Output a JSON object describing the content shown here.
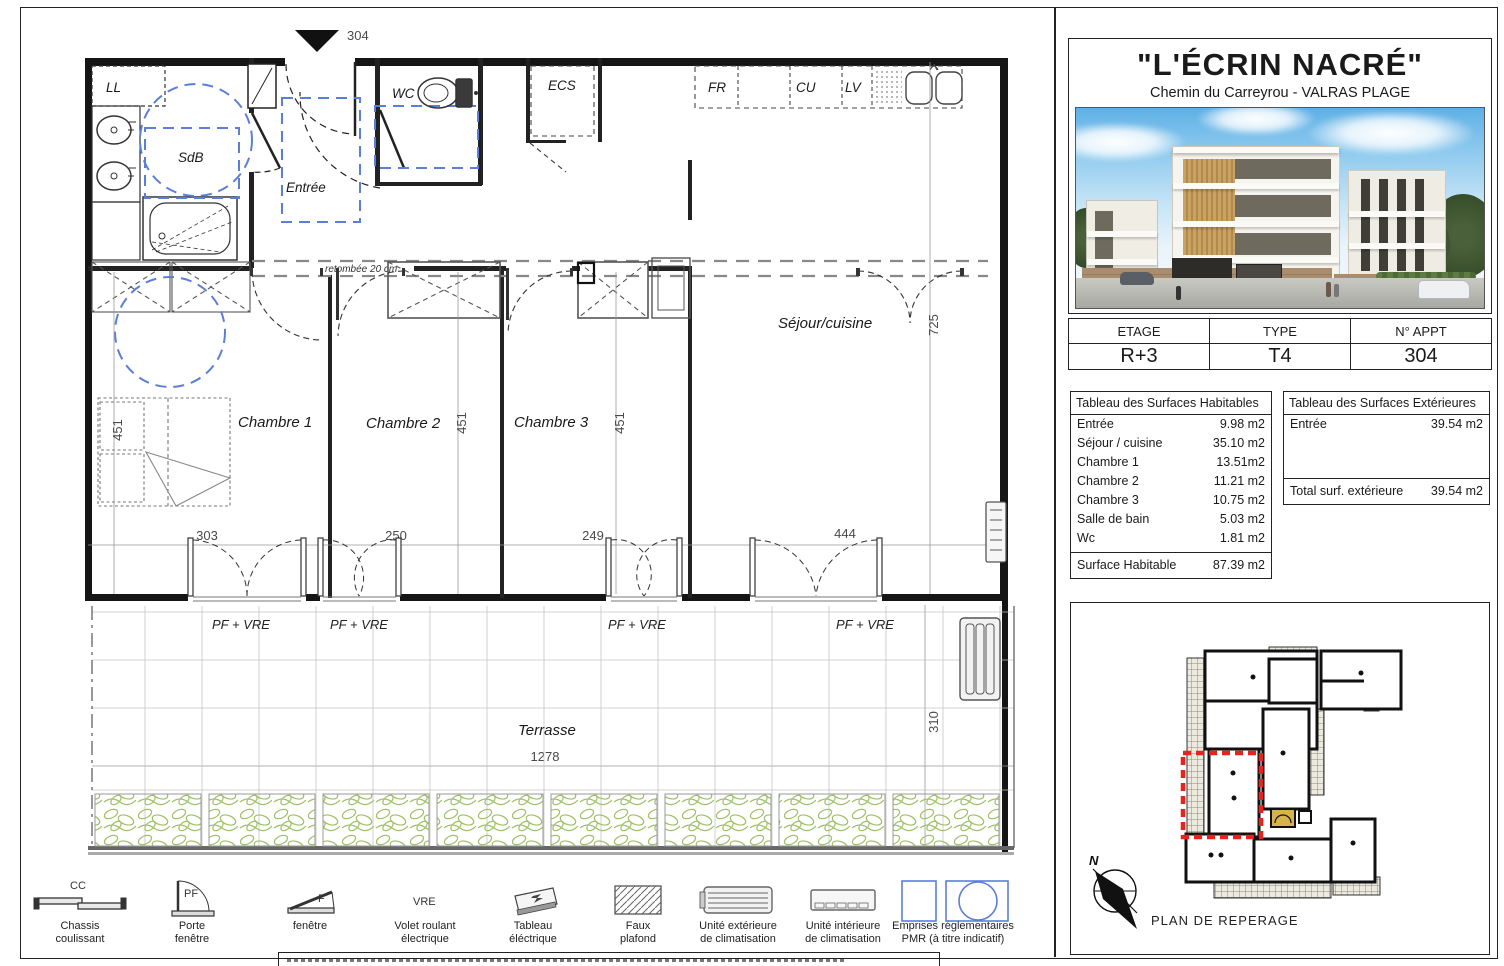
{
  "title_block": {
    "title": "\"L'ÉCRIN NACRÉ\"",
    "subtitle": "Chemin du Carreyrou - VALRAS PLAGE"
  },
  "info_table": {
    "col1_header": "ETAGE",
    "col2_header": "TYPE",
    "col3_header": "N° APPT",
    "col1_value": "R+3",
    "col2_value": "T4",
    "col3_value": "304"
  },
  "surfaces_habitables": {
    "title": "Tableau des Surfaces Habitables",
    "rows": [
      {
        "label": "Entrée",
        "value": "9.98 m2"
      },
      {
        "label": "Séjour / cuisine",
        "value": "35.10 m2"
      },
      {
        "label": "Chambre 1",
        "value": "13.51m2"
      },
      {
        "label": "Chambre 2",
        "value": "11.21 m2"
      },
      {
        "label": "Chambre 3",
        "value": "10.75 m2"
      },
      {
        "label": "Salle de bain",
        "value": "5.03 m2"
      },
      {
        "label": "Wc",
        "value": "1.81 m2"
      }
    ],
    "total_label": "Surface Habitable",
    "total_value": "87.39 m2"
  },
  "surfaces_exterieures": {
    "title": "Tableau des Surfaces Extérieures",
    "rows": [
      {
        "label": "Entrée",
        "value": "39.54 m2"
      }
    ],
    "total_label": "Total surf. extérieure",
    "total_value": "39.54 m2"
  },
  "reperage": {
    "caption": "PLAN DE REPERAGE",
    "north": "N"
  },
  "plan": {
    "apt_marker": "304",
    "rooms": {
      "ll": "LL",
      "sdb": "SdB",
      "entree": "Entrée",
      "wc": "WC",
      "ecs": "ECS",
      "fr": "FR",
      "cu": "CU",
      "lv": "LV",
      "sejour": "Séjour/cuisine",
      "ch1": "Chambre 1",
      "ch2": "Chambre 2",
      "ch3": "Chambre 3",
      "terrasse": "Terrasse"
    },
    "dims": {
      "h_ch1": "451",
      "h_ch2": "451",
      "h_ch3": "451",
      "h_sejour": "725",
      "w_ch1": "303",
      "w_ch2": "250",
      "w_ch3": "249",
      "w_sejour": "444",
      "w_terrasse": "1278",
      "h_terrasse": "310"
    },
    "note_retombee": "retombée 20 cm",
    "window_label": "PF + VRE"
  },
  "legend": {
    "items": [
      {
        "code": "CC",
        "line1": "Chassis",
        "line2": "coulissant"
      },
      {
        "code": "PF",
        "line1": "Porte",
        "line2": "fenêtre"
      },
      {
        "code": "F",
        "line1": "fenêtre",
        "line2": ""
      },
      {
        "code": "VRE",
        "line1": "Volet roulant",
        "line2": "électrique"
      },
      {
        "code": "",
        "line1": "Tableau",
        "line2": "éléctrique"
      },
      {
        "code": "",
        "line1": "Faux",
        "line2": "plafond"
      },
      {
        "code": "",
        "line1": "Unité extérieure",
        "line2": "de climatisation"
      },
      {
        "code": "",
        "line1": "Unité intérieure",
        "line2": "de climatisation"
      },
      {
        "code": "",
        "line1": "Emprises réglementaires",
        "line2": "PMR (à titre indicatif)"
      }
    ]
  },
  "colors": {
    "pmr_blue": "#5b7fd8",
    "unit_red": "#e8231d",
    "foliage_green": "#a7c876",
    "wall_black": "#151515"
  }
}
